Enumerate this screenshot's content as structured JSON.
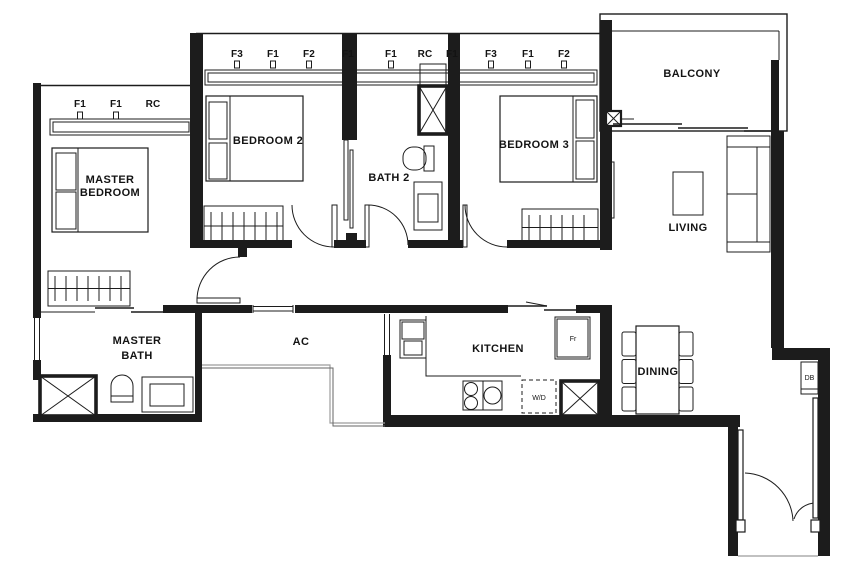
{
  "plan": {
    "rooms": {
      "master_bedroom": {
        "line1": "MASTER",
        "line2": "BEDROOM"
      },
      "bedroom_2": {
        "label": "BEDROOM 2"
      },
      "bath_2": {
        "label": "BATH 2"
      },
      "bedroom_3": {
        "label": "BEDROOM 3"
      },
      "balcony": {
        "label": "BALCONY"
      },
      "living": {
        "label": "LIVING"
      },
      "master_bath": {
        "line1": "MASTER",
        "line2": "BATH"
      },
      "ac_ledge": {
        "label": "AC"
      },
      "kitchen": {
        "label": "KITCHEN"
      },
      "dining": {
        "label": "DINING"
      }
    },
    "wall_markers": {
      "top": [
        "F3",
        "F1",
        "F2",
        "F1",
        "F1",
        "RC",
        "F1",
        "F3",
        "F1",
        "F2"
      ],
      "left": [
        "F1",
        "F1",
        "RC"
      ]
    },
    "fixtures": {
      "fridge": "Fr",
      "washer_dryer": "W/D",
      "distribution_board": "DB"
    },
    "colors": {
      "wall": "#1c1c1c",
      "background": "#ffffff",
      "ledge_edge": "#9c9c9c"
    }
  }
}
